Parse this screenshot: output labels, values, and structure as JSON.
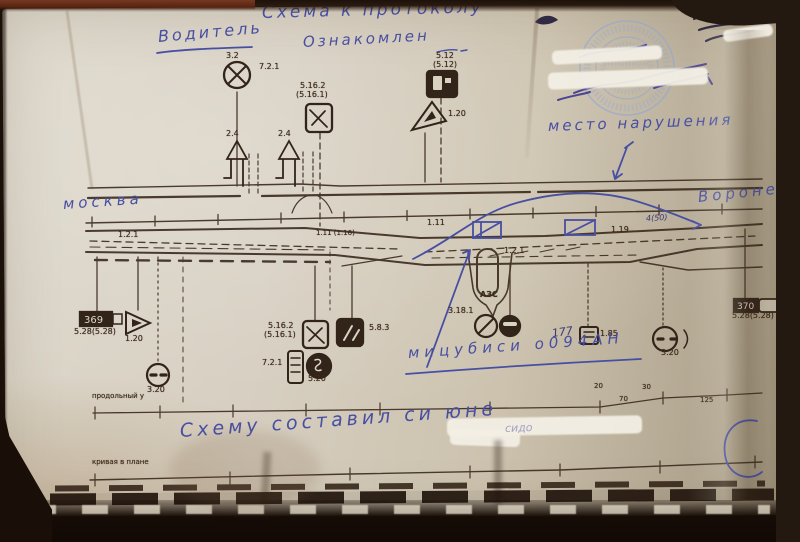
{
  "colors": {
    "paper": "#d6cfc0",
    "ink": "#3b2a1d",
    "pen_blue": "#474fa3",
    "stamp_blue": "#8ea6d8"
  },
  "handwriting": {
    "title": "Схема к протоколу",
    "driver": "Водитель",
    "acknowledged": "Ознакомлен",
    "place": "место нарушения",
    "city_left": "москва",
    "city_right": "Воронеж",
    "vehicle": "мицубиси  о094АН",
    "num_note": "177",
    "tiny_note": "4(50)",
    "composed": "Схему составил си юне",
    "redacted_visible": "сидо"
  },
  "printed": {
    "s3_2": "3.2",
    "s7_2_1_a": "7.2.1",
    "s5_16_2_a": "5.16.2",
    "s5_16_1_a": "(5.16.1)",
    "s5_12": "5.12",
    "s5_12_b": "(5.12)",
    "s2_4_a": "2.4",
    "s2_4_b": "2.4",
    "s1_20_a": "1.20",
    "s1_2_1_a": "1.2.1",
    "s1_11_16": "1.11 (1.16)",
    "s1_11": "1.11",
    "s1_19": "1.19",
    "s1_2_1_b": "1.2.1",
    "km369": "369",
    "s5_28_a": "5.28(5.28)",
    "s1_20_b": "1.20",
    "s3_20_a": "3.20",
    "row1_label": "продольный у",
    "s5_16_2_b": "5.16.2",
    "s5_16_1_b": "(5.16.1)",
    "s7_2_1_b": "7.2.1",
    "s5_20": "5.20",
    "s5_8_3": "5.8.3",
    "s3_18_1": "3.18.1",
    "azs": "АЗС",
    "s1_85": "1.85",
    "s3_20_b": "3.20",
    "km370": "370",
    "s5_28_b": "5.28(5.28)",
    "p20": "20",
    "p70": "70",
    "p30": "30",
    "p125": "125",
    "row2_label": "кривая в плане"
  }
}
